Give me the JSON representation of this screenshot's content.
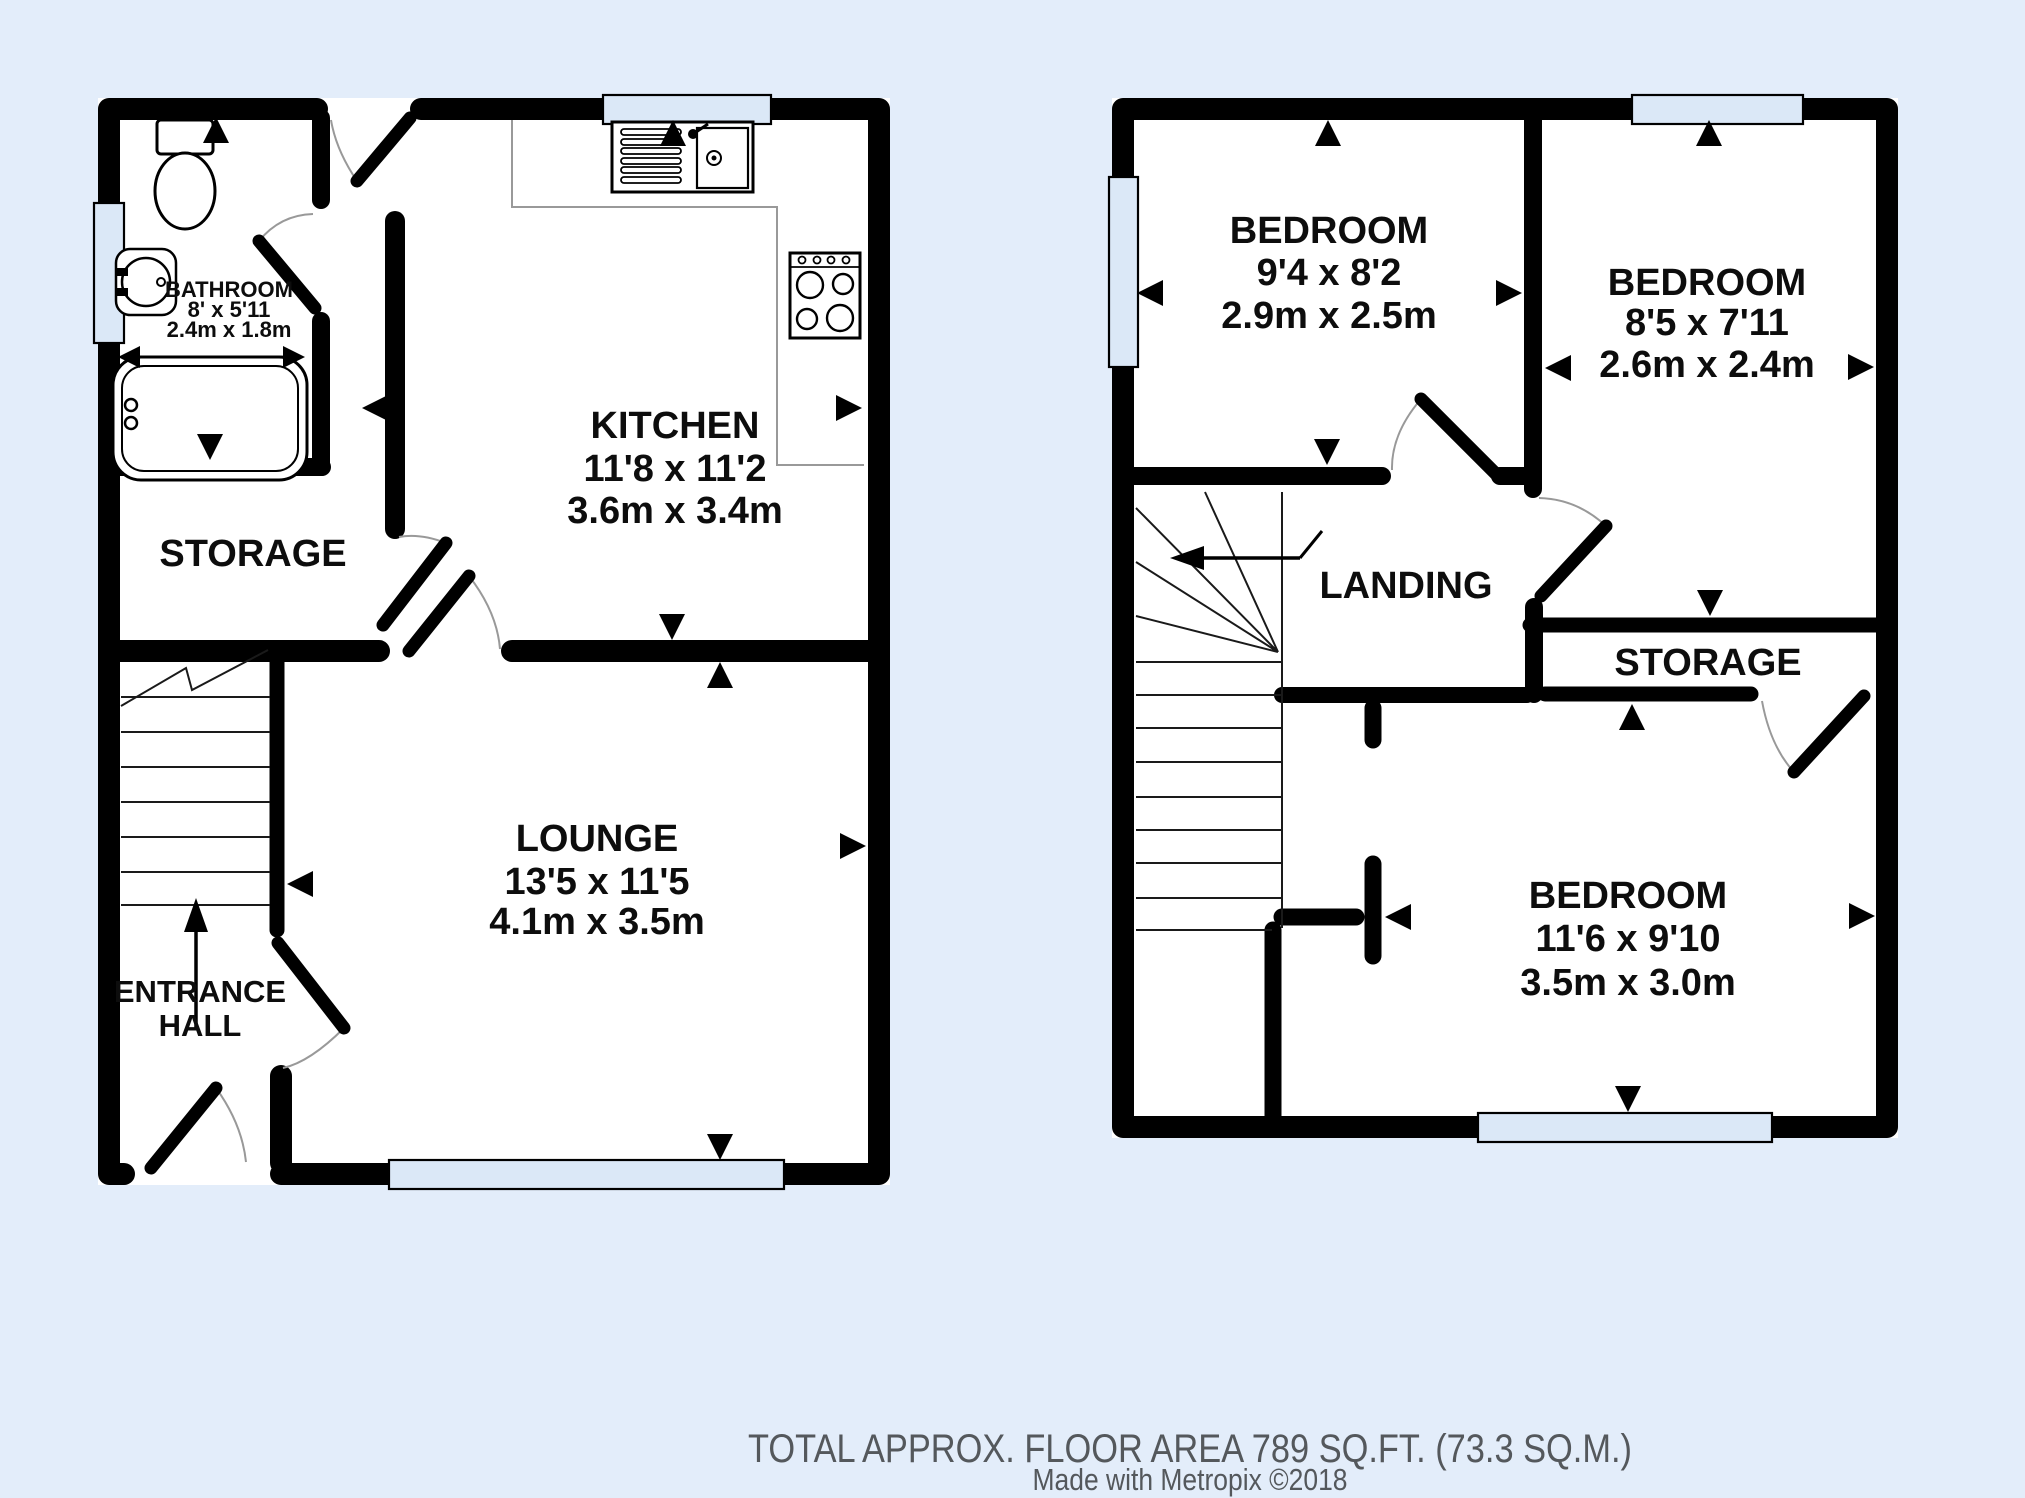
{
  "meta": {
    "background_color": "#e3edfa",
    "wall_color": "#000000",
    "window_fill": "#dbe8f7",
    "footer_text_color": "#54585c",
    "floor_fill": "#ffffff"
  },
  "ground_floor": {
    "bathroom": {
      "name": "BATHROOM",
      "imperial": "8' x 5'11",
      "metric": "2.4m x 1.8m"
    },
    "kitchen": {
      "name": "KITCHEN",
      "imperial": "11'8 x 11'2",
      "metric": "3.6m x 3.4m"
    },
    "storage": {
      "name": "STORAGE"
    },
    "lounge": {
      "name": "LOUNGE",
      "imperial": "13'5 x 11'5",
      "metric": "4.1m x 3.5m"
    },
    "entrance_hall": {
      "line1": "ENTRANCE",
      "line2": "HALL"
    }
  },
  "first_floor": {
    "bedroom1": {
      "name": "BEDROOM",
      "imperial": "9'4 x 8'2",
      "metric": "2.9m x 2.5m"
    },
    "bedroom2": {
      "name": "BEDROOM",
      "imperial": "8'5 x 7'11",
      "metric": "2.6m x 2.4m"
    },
    "landing": {
      "name": "LANDING"
    },
    "storage": {
      "name": "STORAGE"
    },
    "bedroom3": {
      "name": "BEDROOM",
      "imperial": "11'6 x 9'10",
      "metric": "3.5m x 3.0m"
    }
  },
  "footer": {
    "area_line": "TOTAL APPROX. FLOOR AREA 789 SQ.FT. (73.3 SQ.M.)",
    "credit_line": "Made with Metropix ©2018"
  }
}
